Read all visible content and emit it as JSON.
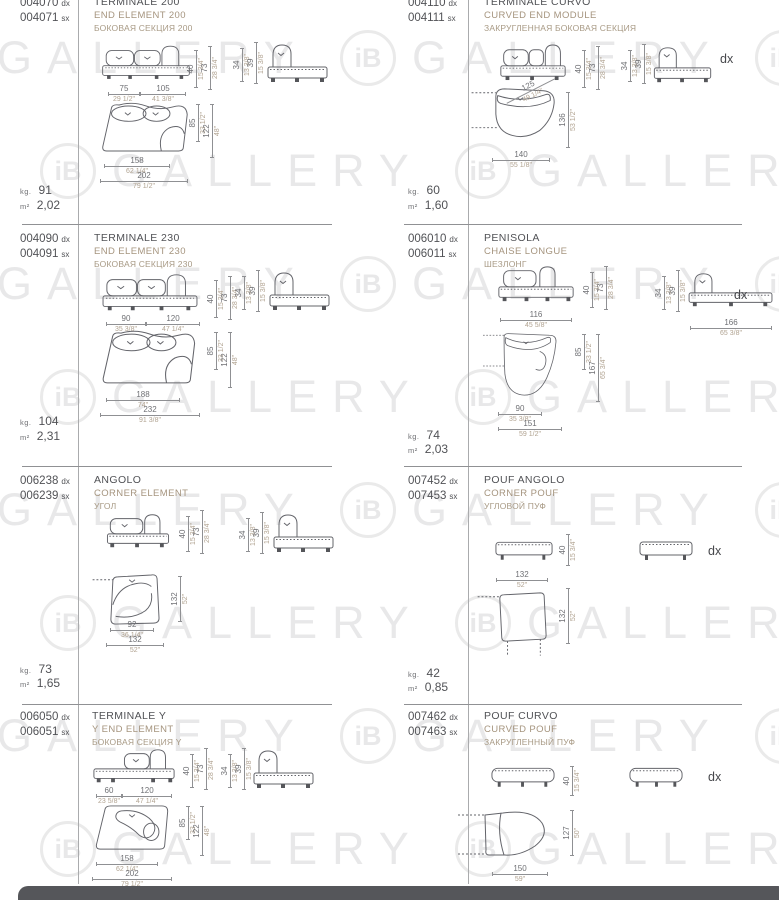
{
  "labels": {
    "kg": "kg.",
    "m2": "m²"
  },
  "watermark": {
    "logo": "iB",
    "text": "GALLERY"
  },
  "cells": [
    {
      "codes": [
        {
          "num": "004070",
          "suf": "dx"
        },
        {
          "num": "004071",
          "suf": "sx"
        }
      ],
      "title_it": "TERMINALE 200",
      "title_en": "END ELEMENT 200",
      "title_ru": "БОКОВАЯ СЕКЦИЯ 200",
      "kg": "91",
      "m2": "2,02",
      "dims": {
        "fw1": {
          "cm": "75",
          "in": "29 1/2\""
        },
        "fw2": {
          "cm": "105",
          "in": "41 3/8\""
        },
        "h1": {
          "cm": "40",
          "in": "15 3/4\""
        },
        "h2": {
          "cm": "73",
          "in": "28 3/4\""
        },
        "s1": {
          "cm": "34",
          "in": "13 3/8\""
        },
        "s2": {
          "cm": "39",
          "in": "15 3/8\""
        },
        "d1": {
          "cm": "85",
          "in": "33 1/2\""
        },
        "d2": {
          "cm": "122",
          "in": "48\""
        },
        "w1": {
          "cm": "158",
          "in": "62 1/4\""
        },
        "w2": {
          "cm": "202",
          "in": "79 1/2\""
        }
      }
    },
    {
      "codes": [
        {
          "num": "004110",
          "suf": "dx"
        },
        {
          "num": "004111",
          "suf": "sx"
        }
      ],
      "title_it": "TERMINALE CURVO",
      "title_en": "CURVED END MODULE",
      "title_ru": "ЗАКРУГЛЕННАЯ БОКОВАЯ СЕКЦИЯ",
      "kg": "60",
      "m2": "1,60",
      "dx_label": "dx",
      "dims": {
        "h1": {
          "cm": "40",
          "in": "15 3/4\""
        },
        "h2": {
          "cm": "73",
          "in": "28 3/4\""
        },
        "s1": {
          "cm": "34",
          "in": "13 3/8\""
        },
        "s2": {
          "cm": "39",
          "in": "15 3/8\""
        },
        "diag": {
          "cm": "125",
          "in": "49 1/4\""
        },
        "d1": {
          "cm": "136",
          "in": "53 1/2\""
        },
        "w1": {
          "cm": "140",
          "in": "55 1/8\""
        }
      }
    },
    {
      "codes": [
        {
          "num": "004090",
          "suf": "dx"
        },
        {
          "num": "004091",
          "suf": "sx"
        }
      ],
      "title_it": "TERMINALE 230",
      "title_en": "END ELEMENT 230",
      "title_ru": "БОКОВАЯ СЕКЦИЯ 230",
      "kg": "104",
      "m2": "2,31",
      "dims": {
        "fw1": {
          "cm": "90",
          "in": "35 3/8\""
        },
        "fw2": {
          "cm": "120",
          "in": "47 1/4\""
        },
        "h1": {
          "cm": "40",
          "in": "15 3/4\""
        },
        "h2": {
          "cm": "73",
          "in": "28 3/4\""
        },
        "s1": {
          "cm": "34",
          "in": "13 3/8\""
        },
        "s2": {
          "cm": "39",
          "in": "15 3/8\""
        },
        "d1": {
          "cm": "85",
          "in": "33 1/2\""
        },
        "d2": {
          "cm": "122",
          "in": "48\""
        },
        "w1": {
          "cm": "188",
          "in": "74\""
        },
        "w2": {
          "cm": "232",
          "in": "91 3/8\""
        }
      }
    },
    {
      "codes": [
        {
          "num": "006010",
          "suf": "dx"
        },
        {
          "num": "006011",
          "suf": "sx"
        }
      ],
      "title_it": "PENISOLA",
      "title_en": "CHAISE LONGUE",
      "title_ru": "ШЕЗЛОНГ",
      "kg": "74",
      "m2": "2,03",
      "dx_label": "dx",
      "dims": {
        "fw1": {
          "cm": "116",
          "in": "45 5/8\""
        },
        "h1": {
          "cm": "40",
          "in": "15 3/4\""
        },
        "h2": {
          "cm": "73",
          "in": "28 3/4\""
        },
        "s1": {
          "cm": "34",
          "in": "13 3/8\""
        },
        "s2": {
          "cm": "39",
          "in": "15 3/8\""
        },
        "sw": {
          "cm": "166",
          "in": "65 3/8\""
        },
        "d1": {
          "cm": "85",
          "in": "33 1/2\""
        },
        "d2": {
          "cm": "167",
          "in": "65 3/4\""
        },
        "w1": {
          "cm": "90",
          "in": "35 3/8\""
        },
        "w2": {
          "cm": "151",
          "in": "59 1/2\""
        }
      }
    },
    {
      "codes": [
        {
          "num": "006238",
          "suf": "dx"
        },
        {
          "num": "006239",
          "suf": "sx"
        }
      ],
      "title_it": "ANGOLO",
      "title_en": "CORNER ELEMENT",
      "title_ru": "УГОЛ",
      "kg": "73",
      "m2": "1,65",
      "dims": {
        "h1": {
          "cm": "40",
          "in": "15 3/4\""
        },
        "h2": {
          "cm": "73",
          "in": "28 3/4\""
        },
        "s1": {
          "cm": "34",
          "in": "13 3/8\""
        },
        "s2": {
          "cm": "39",
          "in": "15 3/8\""
        },
        "d1": {
          "cm": "132",
          "in": "52\""
        },
        "w1": {
          "cm": "92",
          "in": "36 1/4\""
        },
        "w2": {
          "cm": "132",
          "in": "52\""
        }
      }
    },
    {
      "codes": [
        {
          "num": "007452",
          "suf": "dx"
        },
        {
          "num": "007453",
          "suf": "sx"
        }
      ],
      "title_it": "POUF ANGOLO",
      "title_en": "CORNER POUF",
      "title_ru": "УГЛОВОЙ ПУФ",
      "kg": "42",
      "m2": "0,85",
      "dx_label": "dx",
      "dims": {
        "h1": {
          "cm": "40",
          "in": "15 3/4\""
        },
        "fw1": {
          "cm": "132",
          "in": "52\""
        },
        "d1": {
          "cm": "132",
          "in": "52\""
        }
      }
    },
    {
      "codes": [
        {
          "num": "006050",
          "suf": "dx"
        },
        {
          "num": "006051",
          "suf": "sx"
        }
      ],
      "title_it": "TERMINALE Y",
      "title_en": "Y END ELEMENT",
      "title_ru": "БОКОВАЯ СЕКЦИЯ Y",
      "dims": {
        "fw1": {
          "cm": "60",
          "in": "23 5/8\""
        },
        "fw2": {
          "cm": "120",
          "in": "47 1/4\""
        },
        "h1": {
          "cm": "40",
          "in": "15 3/4\""
        },
        "h2": {
          "cm": "73",
          "in": "28 3/4\""
        },
        "s1": {
          "cm": "34",
          "in": "13 3/8\""
        },
        "s2": {
          "cm": "39",
          "in": "15 3/8\""
        },
        "d1": {
          "cm": "85",
          "in": "33 1/2\""
        },
        "d2": {
          "cm": "122",
          "in": "48\""
        },
        "w1": {
          "cm": "158",
          "in": "62 1/4\""
        },
        "w2": {
          "cm": "202",
          "in": "79 1/2\""
        }
      }
    },
    {
      "codes": [
        {
          "num": "007462",
          "suf": "dx"
        },
        {
          "num": "007463",
          "suf": "sx"
        }
      ],
      "title_it": "POUF CURVO",
      "title_en": "CURVED POUF",
      "title_ru": "ЗАКРУГЛЕННЫЙ ПУФ",
      "dx_label": "dx",
      "dims": {
        "h1": {
          "cm": "40",
          "in": "15 3/4\""
        },
        "d1": {
          "cm": "127",
          "in": "50\""
        },
        "w1": {
          "cm": "150",
          "in": "59\""
        }
      }
    }
  ]
}
